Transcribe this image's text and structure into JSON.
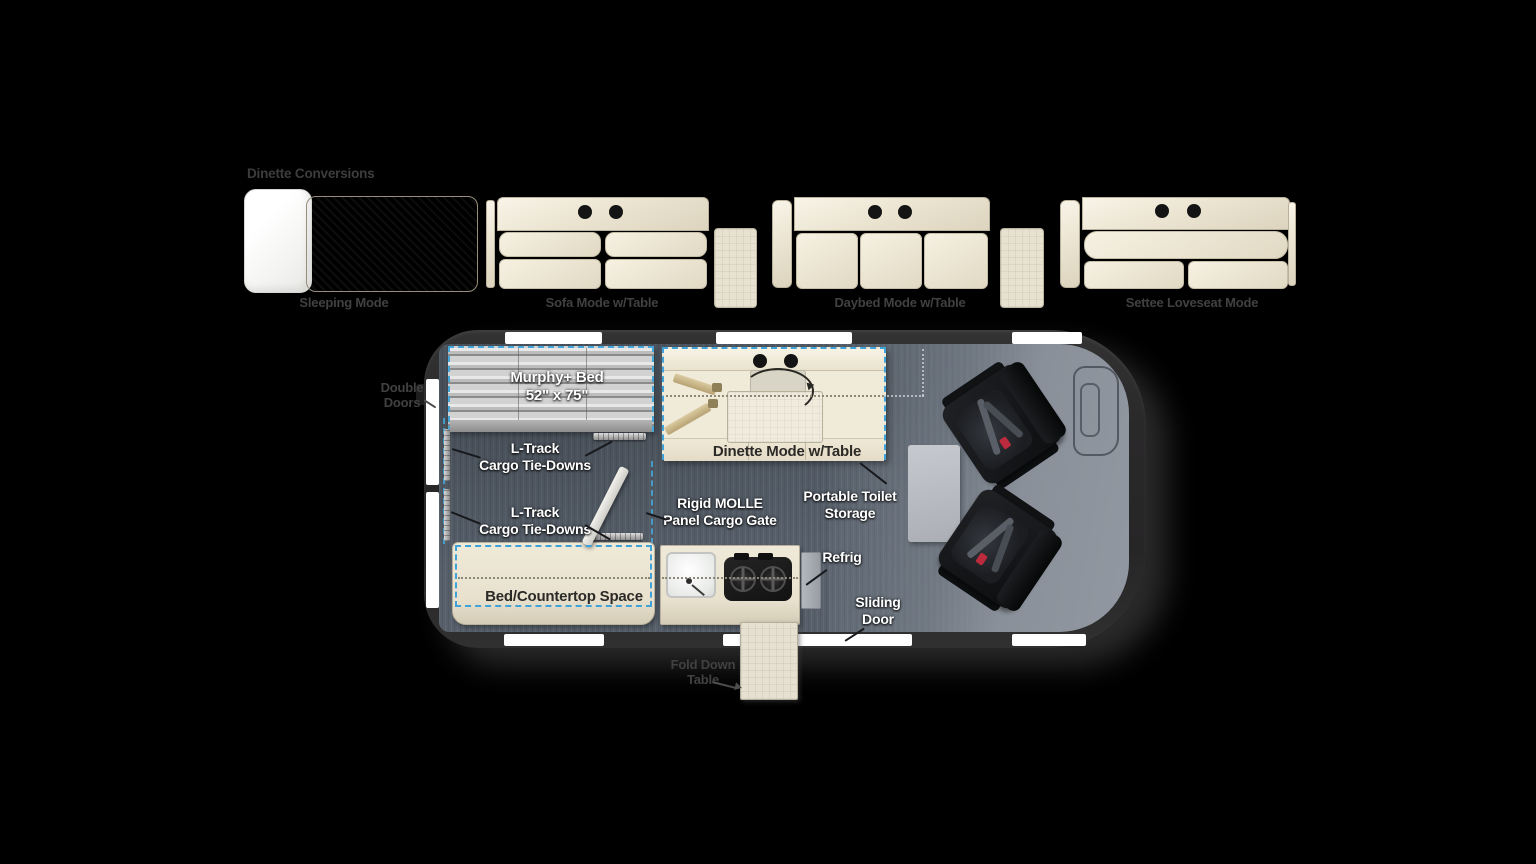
{
  "section_title": "Dinette Conversions",
  "conversions": {
    "sleeping_label": "Sleeping Mode",
    "sofa_label": "Sofa Mode w/Table",
    "daybed_label": "Daybed Mode w/Table",
    "settee_label": "Settee Loveseat Mode"
  },
  "floorplan": {
    "murphy_bed": {
      "line1": "Murphy+ Bed",
      "line2": "52\" x 75\""
    },
    "ltrack_upper": {
      "line1": "L-Track",
      "line2": "Cargo Tie-Downs"
    },
    "ltrack_lower": {
      "line1": "L-Track",
      "line2": "Cargo Tie-Downs"
    },
    "molle": {
      "line1": "Rigid MOLLE",
      "line2": "Panel Cargo Gate"
    },
    "dinette_label": "Dinette Mode w/Table",
    "portable_toilet": {
      "line1": "Portable Toilet",
      "line2": "Storage"
    },
    "refrig_label": "Refrig",
    "sliding_door": {
      "line1": "Sliding",
      "line2": "Door"
    },
    "bed_countertop_label": "Bed/Countertop Space",
    "fold_table": {
      "line1": "Fold Down",
      "line2": "Table"
    },
    "double_doors": {
      "line1": "Double",
      "line2": "Doors"
    }
  },
  "colors": {
    "background": "#000000",
    "accent_dashed": "#3fa3da",
    "cargo_floor": "#57606b",
    "cab_floor": "#8a9099",
    "van_wall": "#2d2c2d",
    "furniture_cream": "#ece5d2",
    "dark_label": "#3d3d3d"
  }
}
